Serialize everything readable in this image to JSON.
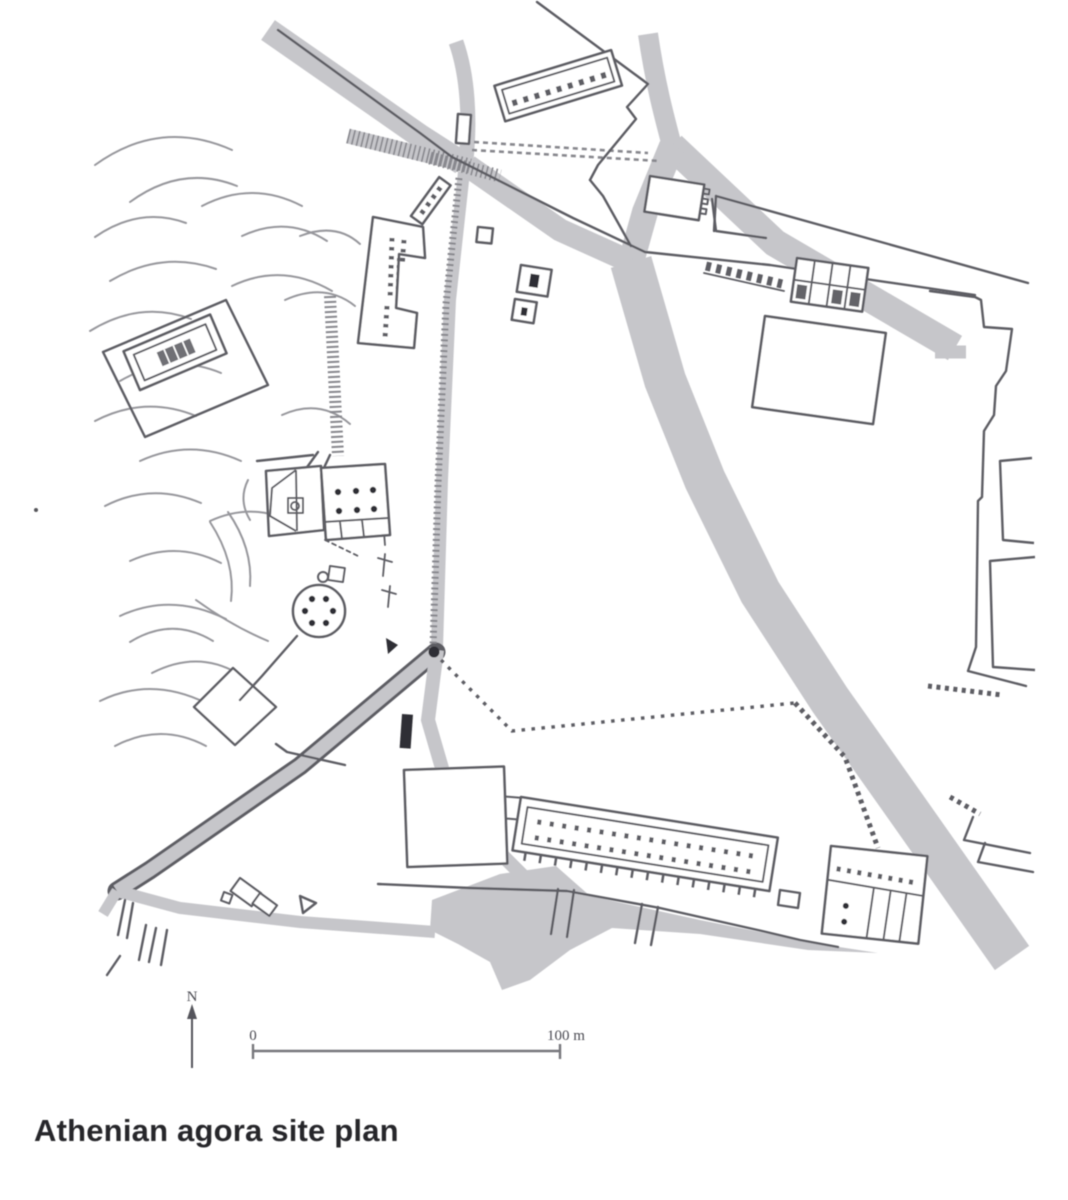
{
  "figure": {
    "caption": "Athenian agora site plan",
    "north_arrow_label": "N",
    "scale_bar": {
      "start_label": "0",
      "end_label": "100 m"
    }
  },
  "colors": {
    "ink": "#2f2f35",
    "wall_line": "#5d5d64",
    "road_fill": "#c6c6ca",
    "contour_line": "#97979c",
    "caption_text": "#26262c"
  }
}
